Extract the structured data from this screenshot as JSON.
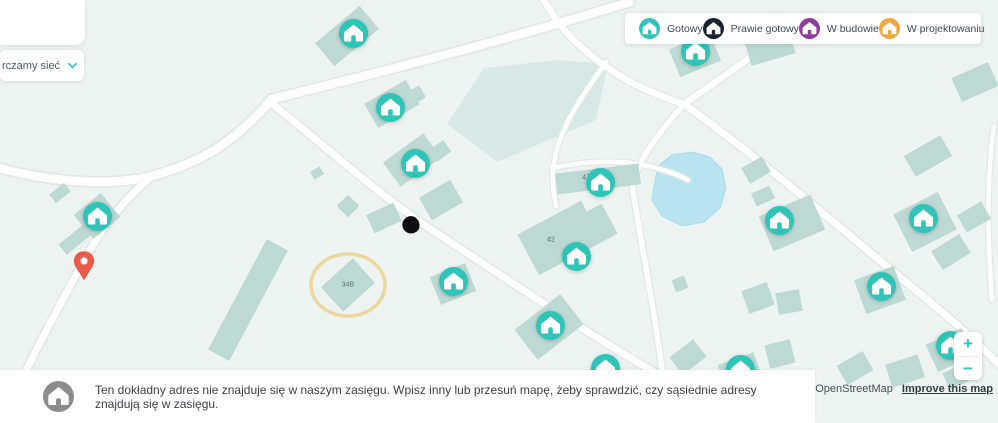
{
  "legend": {
    "items": [
      {
        "status": "gotowy",
        "label": "Gotowy",
        "color": "#2ec4b6"
      },
      {
        "status": "prawie-gotowy",
        "label": "Prawie gotowy",
        "color": "#18222d"
      },
      {
        "status": "w-budowie",
        "label": "W budowie",
        "color": "#8e3b9f"
      },
      {
        "status": "w-projektowaniu",
        "label": "W projektowaniu",
        "color": "#f3a73a"
      }
    ]
  },
  "panel": {
    "dropdown_text": "rczamy sieć"
  },
  "notice": {
    "line1": "Ten dokładny adres nie znajduje się w naszym zasięgu. Wpisz inny lub przesuń mapę, żeby sprawdzić, czy sąsiednie adresy",
    "line2": "znajdują się w zasięgu.",
    "icon": "home-icon",
    "icon_color": "#8c8c8c"
  },
  "attribution": {
    "mapbox": "Mapbox © OpenStreetMap",
    "improve": "Improve this map"
  },
  "zoom_controls": {
    "zoom_in": "+",
    "zoom_out": "−"
  },
  "map": {
    "pin": {
      "x": 84,
      "y": 281,
      "color": "#e85a4a"
    },
    "highlight_ring": {
      "x": 348,
      "y": 285,
      "rx": 37,
      "ry": 31
    },
    "building_labels": [
      {
        "text": "47",
        "x": 586,
        "y": 178
      },
      {
        "text": "42",
        "x": 551,
        "y": 240
      },
      {
        "text": "34B",
        "x": 348,
        "y": 285
      }
    ],
    "markers": [
      {
        "x": 353,
        "y": 33,
        "status": "gotowy"
      },
      {
        "x": 695,
        "y": 51,
        "status": "gotowy"
      },
      {
        "x": 390,
        "y": 107,
        "status": "gotowy"
      },
      {
        "x": 415,
        "y": 163,
        "status": "gotowy"
      },
      {
        "x": 600,
        "y": 182,
        "status": "gotowy"
      },
      {
        "x": 97,
        "y": 216,
        "status": "gotowy"
      },
      {
        "x": 923,
        "y": 218,
        "status": "gotowy"
      },
      {
        "x": 779,
        "y": 220,
        "status": "gotowy"
      },
      {
        "x": 576,
        "y": 256,
        "status": "gotowy"
      },
      {
        "x": 453,
        "y": 281,
        "status": "gotowy"
      },
      {
        "x": 881,
        "y": 286,
        "status": "gotowy"
      },
      {
        "x": 550,
        "y": 325,
        "status": "gotowy"
      },
      {
        "x": 950,
        "y": 345,
        "status": "gotowy"
      },
      {
        "x": 605,
        "y": 368,
        "status": "gotowy"
      },
      {
        "x": 740,
        "y": 369,
        "status": "gotowy"
      }
    ]
  }
}
